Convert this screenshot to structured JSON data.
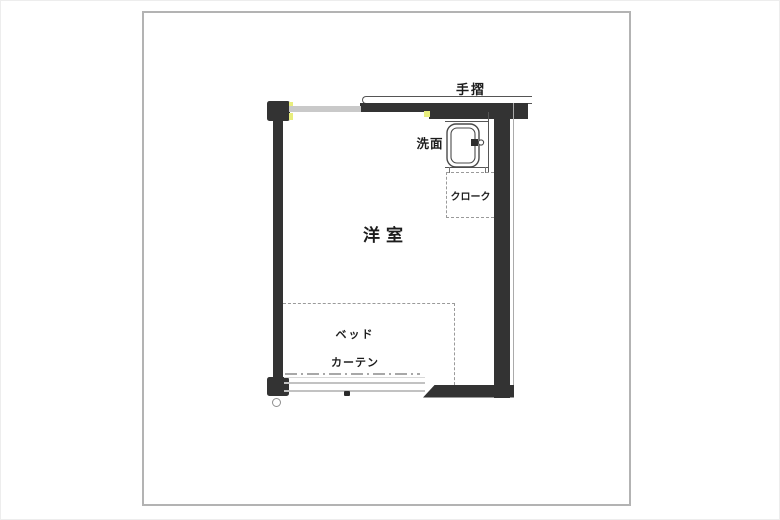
{
  "plan": {
    "labels": {
      "handrail": "手摺",
      "washbasin": "洗面",
      "cloak": "クローク",
      "room": "洋室",
      "bed": "ベッド",
      "curtain": "カーテン"
    },
    "colors": {
      "wall": "#333333",
      "window_gray": "#c9c9c9",
      "dashed_gray": "#9a9a9a",
      "outline_gray": "#b3b3b3",
      "highlight_yellow": "#e8ee7d",
      "fixture_stroke": "#4a4a4a",
      "text": "#1c1c1c"
    }
  }
}
